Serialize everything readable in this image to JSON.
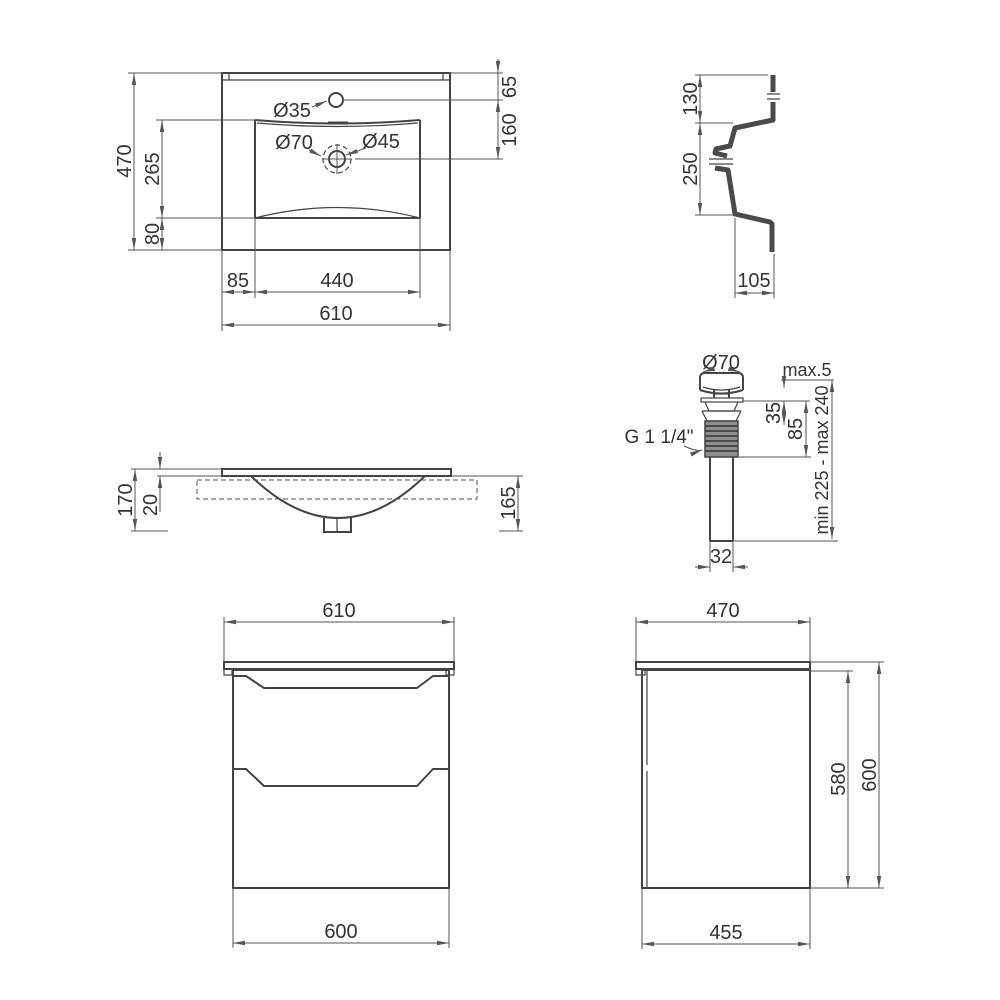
{
  "views": {
    "sink_top": {
      "name": "washbasin-top-view",
      "labels": {
        "faucet_hole": "Ø35",
        "drain_outer": "Ø70",
        "drain_inner": "Ø45",
        "depth": "470",
        "basin_depth": "265",
        "front": "80",
        "left_offset": "85",
        "basin_width": "440",
        "width": "610",
        "faucet_offset": "65",
        "drain_offset": "160"
      }
    },
    "sink_section": {
      "name": "washbasin-side-section",
      "labels": {
        "rim": "130",
        "bowl": "250",
        "bottom": "105"
      }
    },
    "drain_valve": {
      "name": "pop-up-drain-detail",
      "labels": {
        "cap": "Ø70",
        "protrusion": "max.5",
        "upper": "35",
        "body": "85",
        "thread": "G 1 1/4\"",
        "range": "min 225 - max 240",
        "pipe": "32"
      }
    },
    "sink_front": {
      "name": "washbasin-front-view",
      "labels": {
        "total": "170",
        "deck": "20",
        "bowl": "165"
      }
    },
    "cabinet_front": {
      "name": "cabinet-front-view",
      "labels": {
        "top": "610",
        "body": "600"
      }
    },
    "cabinet_side": {
      "name": "cabinet-side-view",
      "labels": {
        "top": "470",
        "inner": "580",
        "total": "600",
        "bottom": "455"
      }
    }
  },
  "colors": {
    "object_line": "#444444",
    "dimension_line": "#555555",
    "section_fill": "#4a4a4a",
    "background": "#ffffff"
  }
}
